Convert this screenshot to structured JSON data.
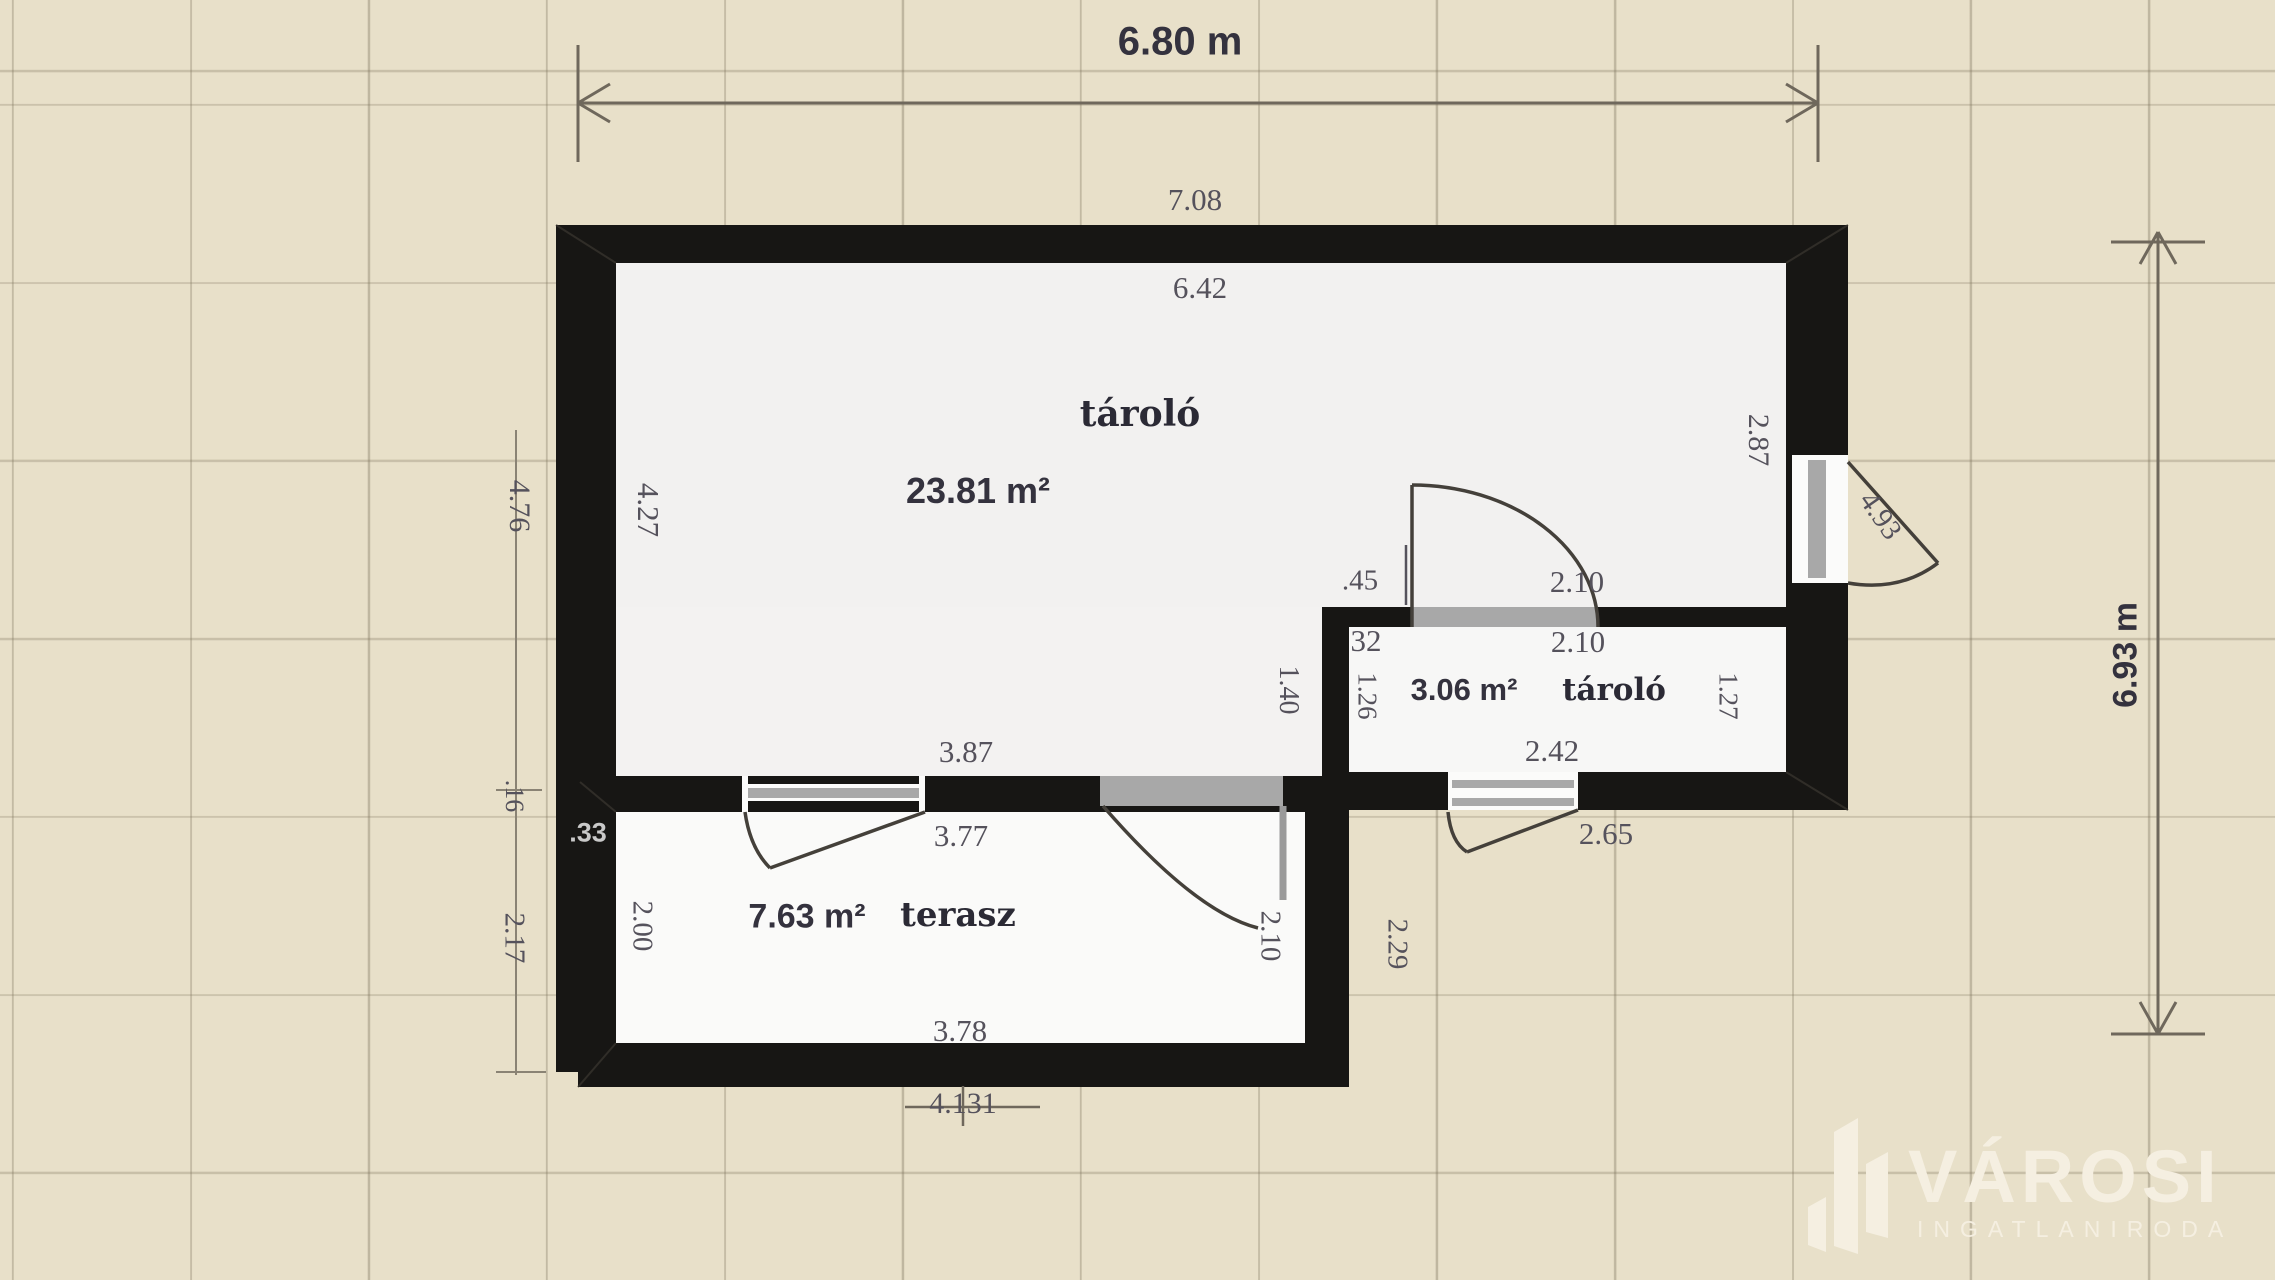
{
  "dims": {
    "overall_width": "6.80 m",
    "overall_height": "6.93 m",
    "top_wall": "7.08",
    "room1_top": "6.42",
    "left_outer": "4.76",
    "room1_left": "4.27",
    "room1_right": "2.87",
    "right_door": "4.93",
    "partition_left": ".45",
    "partition_opening_top": "2.10",
    "partition_left_inner": "32",
    "partition_opening_bottom": "2.10",
    "room2_outside_left": "1.40",
    "room2_left": "1.26",
    "room2_right": "1.27",
    "room2_bottom": "2.42",
    "room2_bottom_outer": "2.65",
    "terrace_wall_top": "3.87",
    "terrace_wall_bottom": "3.77",
    "terrace_corner": ".33",
    "left_mid": ".16",
    "left_terrace": "2.17",
    "terrace_left_inner": "2.00",
    "terrace_door": "2.10",
    "terrace_right_outer": "2.29",
    "terrace_bottom": "3.78",
    "bottom_outer": "4.131"
  },
  "rooms": [
    {
      "name": "tároló",
      "area": "23.81 m²"
    },
    {
      "name": "tároló",
      "area": "3.06 m²"
    },
    {
      "name": "terasz",
      "area": "7.63 m²"
    }
  ],
  "logo": {
    "title": "VÁROSI",
    "subtitle": "INGATLANIRODA"
  }
}
